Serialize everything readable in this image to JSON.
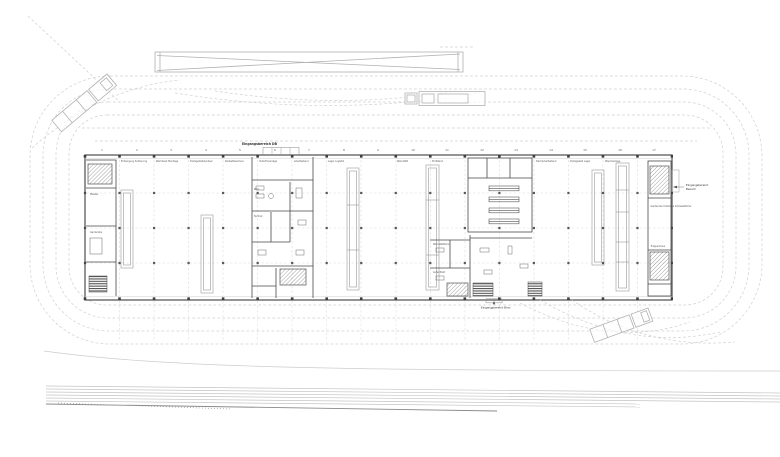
{
  "plan": {
    "entrances": {
      "db": "Eingangsbereich DB",
      "besuch_line1": "Eingangsbereich",
      "besuch_line2": "Besuch",
      "buero": "Eingangsbereich Büro"
    },
    "axes": [
      "1",
      "2",
      "3",
      "4",
      "5",
      "6",
      "7",
      "8",
      "9",
      "10",
      "11",
      "12",
      "13",
      "14",
      "15",
      "16",
      "17"
    ],
    "bays": [
      "Entsorgung Sortierung",
      "Werkbank Montage",
      "Drehgestellwechsel",
      "Radsatzwechsel",
      "Unterfluranlage",
      "Arbeitsstand",
      "Lager Logistik",
      "Werkstatt",
      "Prüfstand",
      "Dacharbeitsstand",
      "Drehgestell Lager",
      "Waschanlage"
    ],
    "rooms": [
      "Meister",
      "Garderobe",
      "Büro",
      "Technik",
      "Werkstattbüro",
      "Aufenthalt",
      "Garderobe Umkleide Schliessfächer",
      "Treppenhaus"
    ],
    "colors": {
      "wall_dark": "#4a4a4a",
      "line_light": "#cfcfcf",
      "line_mid": "#9e9e9e"
    }
  }
}
